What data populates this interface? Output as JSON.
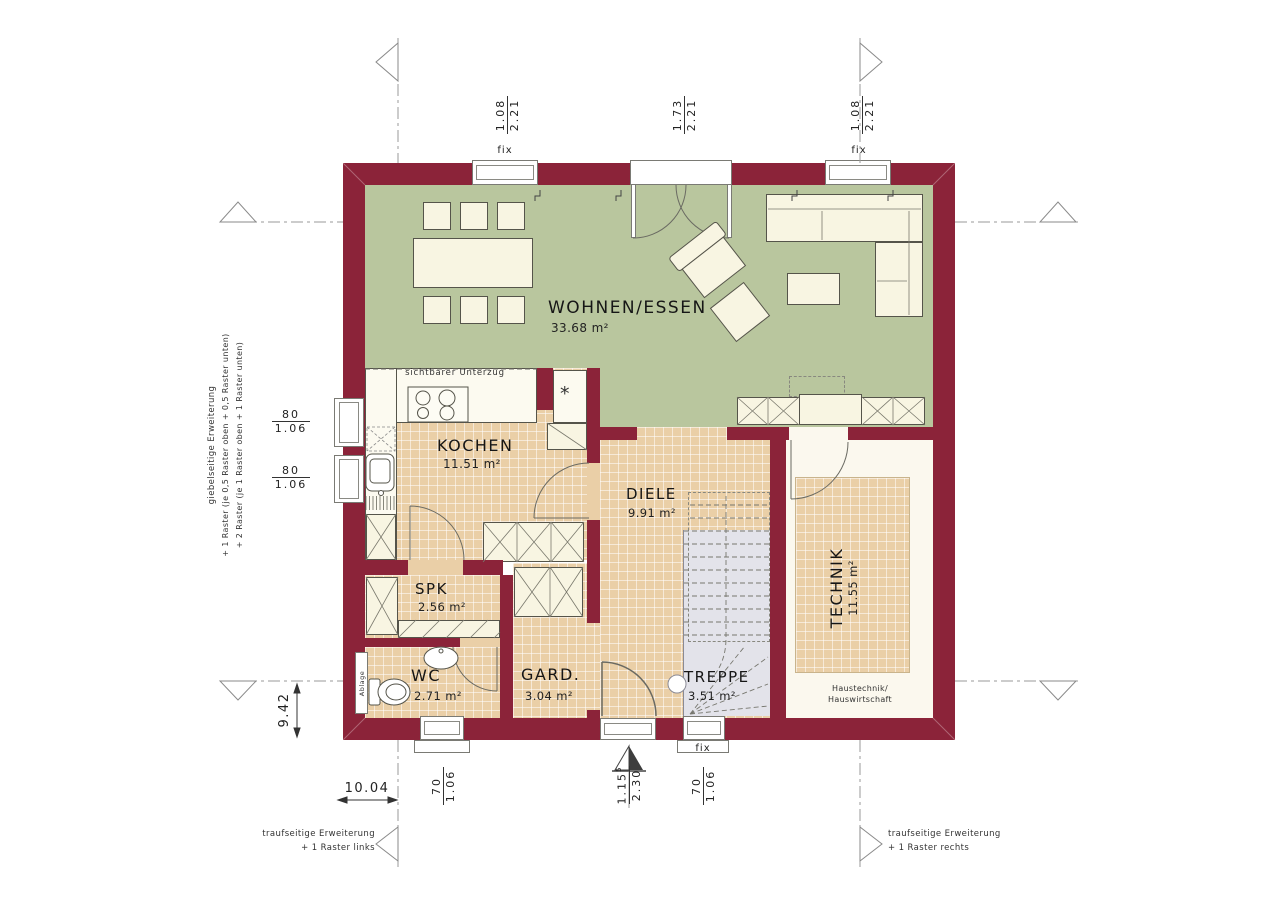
{
  "plan_type": "Erdgeschoss Grundriss (ground floor plan)",
  "rooms": {
    "wohnen": {
      "name": "WOHNEN/ESSEN",
      "area": "33.68 m²"
    },
    "kochen": {
      "name": "KOCHEN",
      "area": "11.51 m²"
    },
    "diele": {
      "name": "DIELE",
      "area": "9.91 m²"
    },
    "spk": {
      "name": "SPK",
      "area": "2.56 m²"
    },
    "wc": {
      "name": "WC",
      "area": "2.71 m²"
    },
    "gard": {
      "name": "GARD.",
      "area": "3.04 m²"
    },
    "treppe": {
      "name": "TREPPE",
      "area": "3.51 m²"
    },
    "technik": {
      "name": "TECHNIK",
      "area": "11.55 m²",
      "note_line1": "Haustechnik/",
      "note_line2": "Hauswirtschaft"
    }
  },
  "labels": {
    "unterzug": "sichtbarer Unterzug",
    "ablage": "Ablage",
    "niche_symbol": "*",
    "fix_top_left": "fix",
    "fix_top_right": "fix",
    "fix_bottom": "fix"
  },
  "dimensions": {
    "top_window_left": {
      "num": "1.08",
      "den": "2.21"
    },
    "top_door": {
      "num": "1.73",
      "den": "2.21"
    },
    "top_window_right": {
      "num": "1.08",
      "den": "2.21"
    },
    "left_window_upper": {
      "num": "80",
      "den": "1.06"
    },
    "left_window_lower": {
      "num": "80",
      "den": "1.06"
    },
    "bottom_wc_window": {
      "num": "70",
      "den": "1.06"
    },
    "bottom_entrance": {
      "num": "1.15",
      "sup": "5",
      "den": "2.30"
    },
    "bottom_fix_window": {
      "num": "70",
      "den": "1.06"
    },
    "total_width": "10.04",
    "total_depth": "9.42"
  },
  "annotations": {
    "gable": [
      "giebelseitige Erweiterung",
      "+ 1 Raster (je 0,5 Raster oben + 0,5 Raster unten)",
      "+ 2 Raster (je 1 Raster oben + 1 Raster unten)"
    ],
    "eaves_left": [
      "traufseitige Erweiterung",
      "+ 1 Raster links"
    ],
    "eaves_right": [
      "traufseitige Erweiterung",
      "+ 1 Raster rechts"
    ]
  },
  "colors": {
    "wall": "#8b2339",
    "living_floor": "#b9c69e",
    "tile_floor": "#eacfa7",
    "furniture": "#f8f5e2",
    "technik_floor": "#fbf8ee",
    "stair": "#e3e3ea",
    "line": "#55544a"
  }
}
